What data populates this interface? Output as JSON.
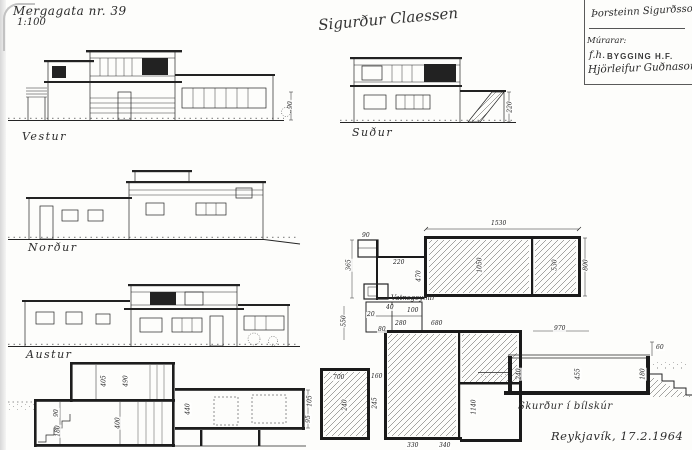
{
  "sheet": {
    "title": "Mergagata nr. 39",
    "scale": "1:100",
    "signature": "Sigurður Claessen",
    "city_date": "Reykjavík, 17.2.1964"
  },
  "stamp": {
    "architect": "Þorsteinn Sigurðsson",
    "role_line": "Múrarar:",
    "fh": "f.h.",
    "company": "BYGGING H.F.",
    "signer": "Hjörleifur Guðnason"
  },
  "elevations": {
    "west": "Vestur",
    "south": "Suður",
    "north": "Norður",
    "east": "Austur",
    "west_dim": "90",
    "south_dim": "220"
  },
  "plan": {
    "tank_label": "Vatnsgeymir",
    "dims": {
      "top_width": "1530",
      "cell_90": "90",
      "left_365": "365",
      "corridor_220": "220",
      "left_470": "470",
      "left_550": "550",
      "room_main": "1050",
      "room_right": "530",
      "right_800": "800",
      "right_970": "970",
      "lower_right_1140": "1140",
      "tank_700": "700",
      "tank_240": "240",
      "gap_160": "160",
      "gap_245": "245",
      "small_280": "280",
      "small_680": "680",
      "small_80": "80",
      "small_100": "100",
      "small_40": "40",
      "small_20": "20",
      "bottom_330": "330",
      "bottom_340": "340"
    }
  },
  "sections": {
    "dims": {
      "upper_405": "405",
      "upper_490": "490",
      "lower_400": "400",
      "left_90": "90",
      "left_180": "180",
      "roof_440": "440",
      "right_105": "105",
      "right_95": "95"
    }
  },
  "garage_section": {
    "label": "Skurður í bílskúr",
    "dims": {
      "wall_240": "240",
      "room_455": "455",
      "right_180": "180",
      "top_60": "60"
    }
  }
}
